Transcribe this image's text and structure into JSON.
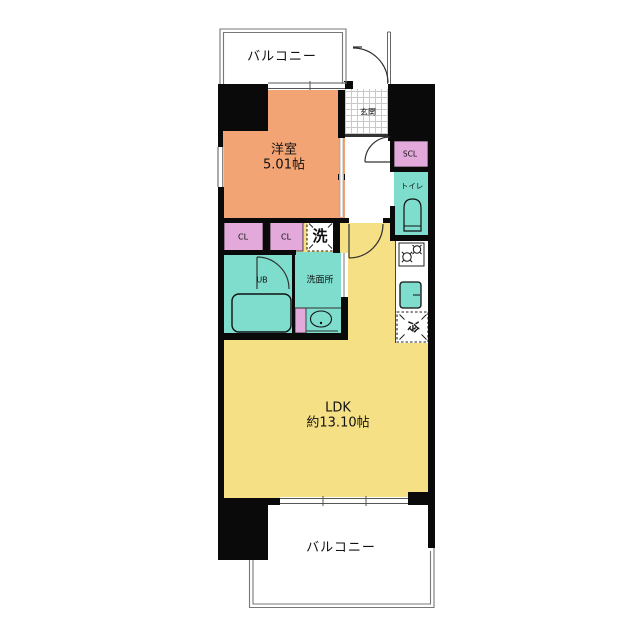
{
  "colors": {
    "wall": "#0a0a0a",
    "western_room": "#f3a474",
    "ldk": "#f6e085",
    "closet": "#e3a9da",
    "wet_area": "#7eddcd",
    "outline": "#333333"
  },
  "rooms": {
    "balcony_top": {
      "label": "バルコニー"
    },
    "western_room": {
      "label": "洋室",
      "size": "5.01帖"
    },
    "entrance": {
      "label": "玄関"
    },
    "shoe_closet": {
      "label": "SCL"
    },
    "toilet": {
      "label": "トイレ"
    },
    "closet_1": {
      "label": "CL"
    },
    "closet_2": {
      "label": "CL"
    },
    "laundry": {
      "label": "洗"
    },
    "unit_bath": {
      "label": "UB"
    },
    "washroom": {
      "label": "洗面所"
    },
    "refrigerator": {
      "label": "冷"
    },
    "ldk": {
      "label": "LDK",
      "size": "約13.10帖"
    },
    "balcony_bottom": {
      "label": "バルコニー"
    }
  }
}
